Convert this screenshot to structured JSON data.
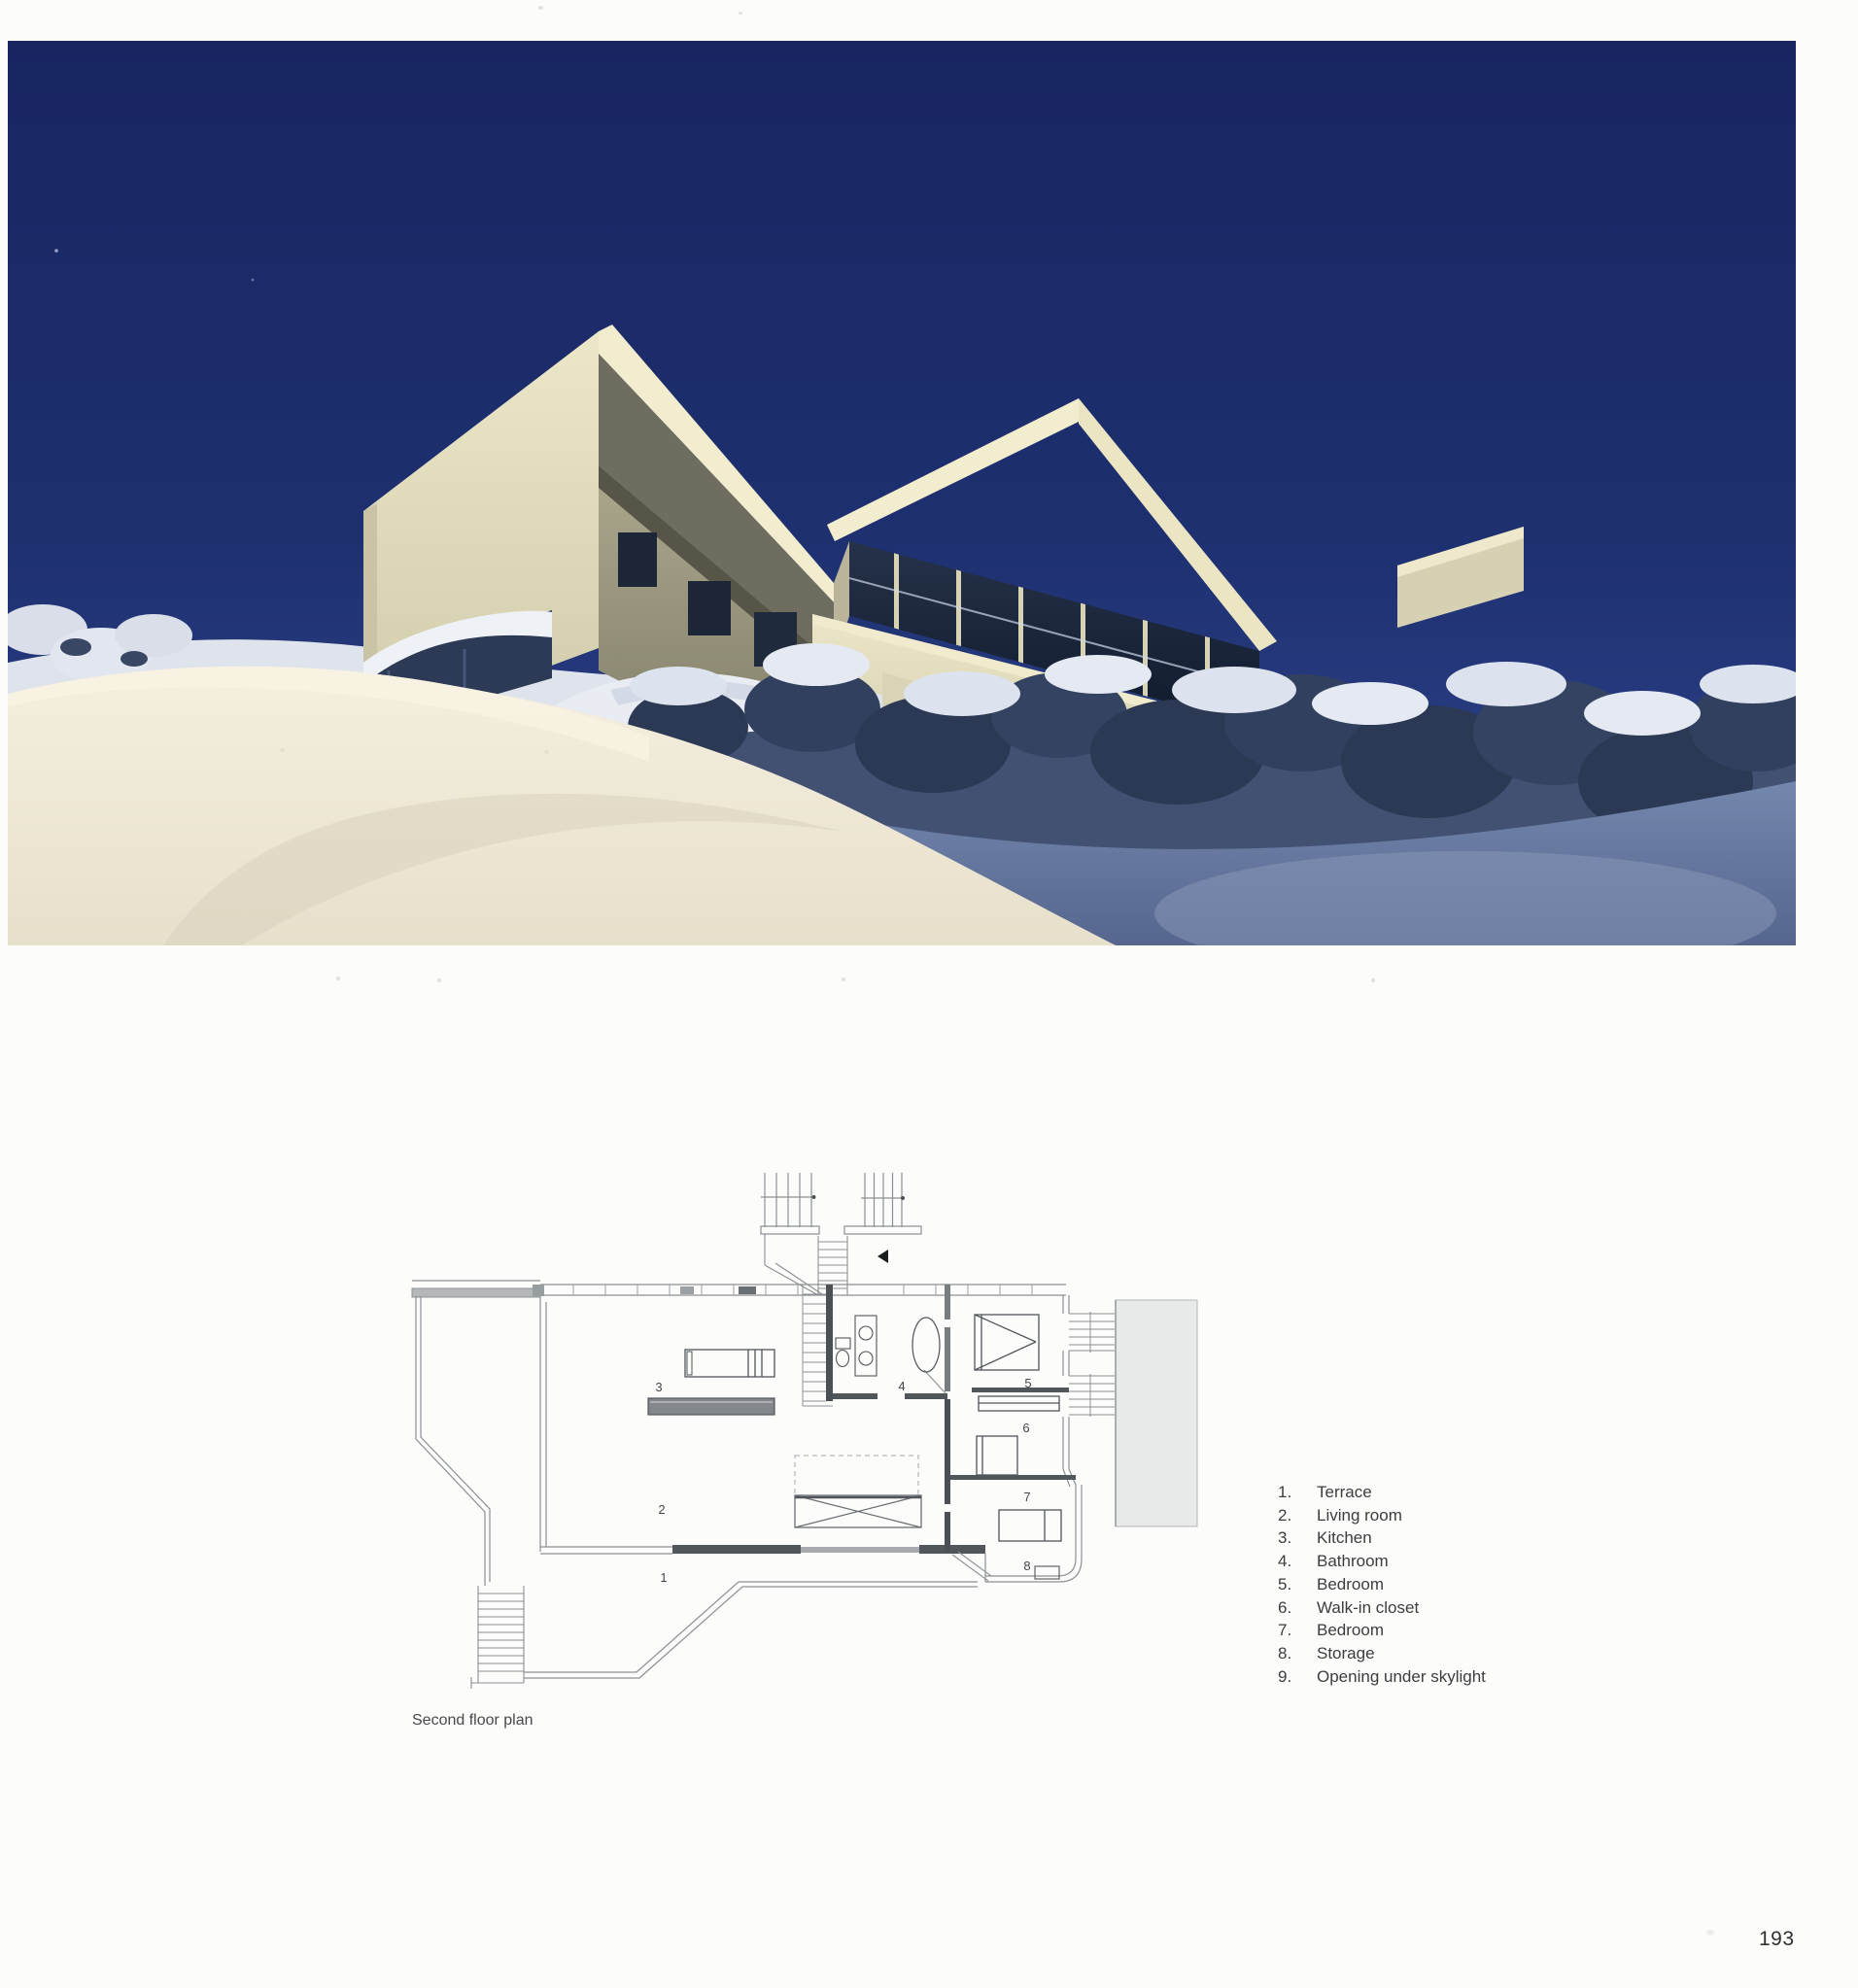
{
  "page": {
    "number": "193",
    "background": "#fcfcfa"
  },
  "plan": {
    "caption": "Second floor plan",
    "room_numbers": [
      "1",
      "2",
      "3",
      "4",
      "5",
      "6",
      "7",
      "8"
    ]
  },
  "legend": {
    "items": [
      {
        "num": "1.",
        "label": "Terrace"
      },
      {
        "num": "2.",
        "label": "Living room"
      },
      {
        "num": "3.",
        "label": "Kitchen"
      },
      {
        "num": "4.",
        "label": "Bathroom"
      },
      {
        "num": "5.",
        "label": "Bedroom"
      },
      {
        "num": "6.",
        "label": "Walk-in closet"
      },
      {
        "num": "7.",
        "label": "Bedroom"
      },
      {
        "num": "8.",
        "label": "Storage"
      },
      {
        "num": "9.",
        "label": "Opening under skylight"
      }
    ]
  },
  "colors": {
    "sky_top": "#182561",
    "sky_bottom": "#33498f",
    "house_cream": "#ece7c8",
    "snow_sunlit": "#f4efdf",
    "snow_shadow": "#55668f",
    "plan_line": "#8b9094",
    "plan_wall_dark": "#4b5054"
  }
}
